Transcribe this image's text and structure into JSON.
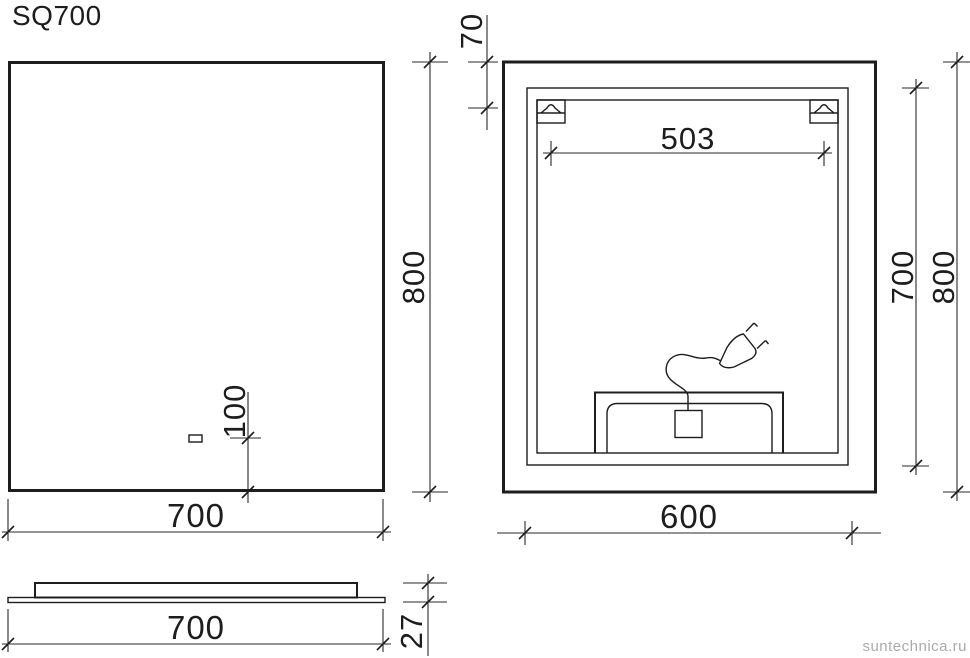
{
  "title": "SQ700",
  "watermark": "suntechnica.ru",
  "colors": {
    "line": "#1d1d1d",
    "watermark": "#aaaaaa",
    "background": "#ffffff"
  },
  "drawing": {
    "front_view": {
      "width": "700",
      "height": "800",
      "sensor_offset": "100"
    },
    "back_view": {
      "width": "600",
      "height": "800",
      "visible_height": "700",
      "bracket_spacing": "503",
      "bracket_top_offset": "70"
    },
    "side_view": {
      "width": "700",
      "thickness": "27"
    }
  }
}
